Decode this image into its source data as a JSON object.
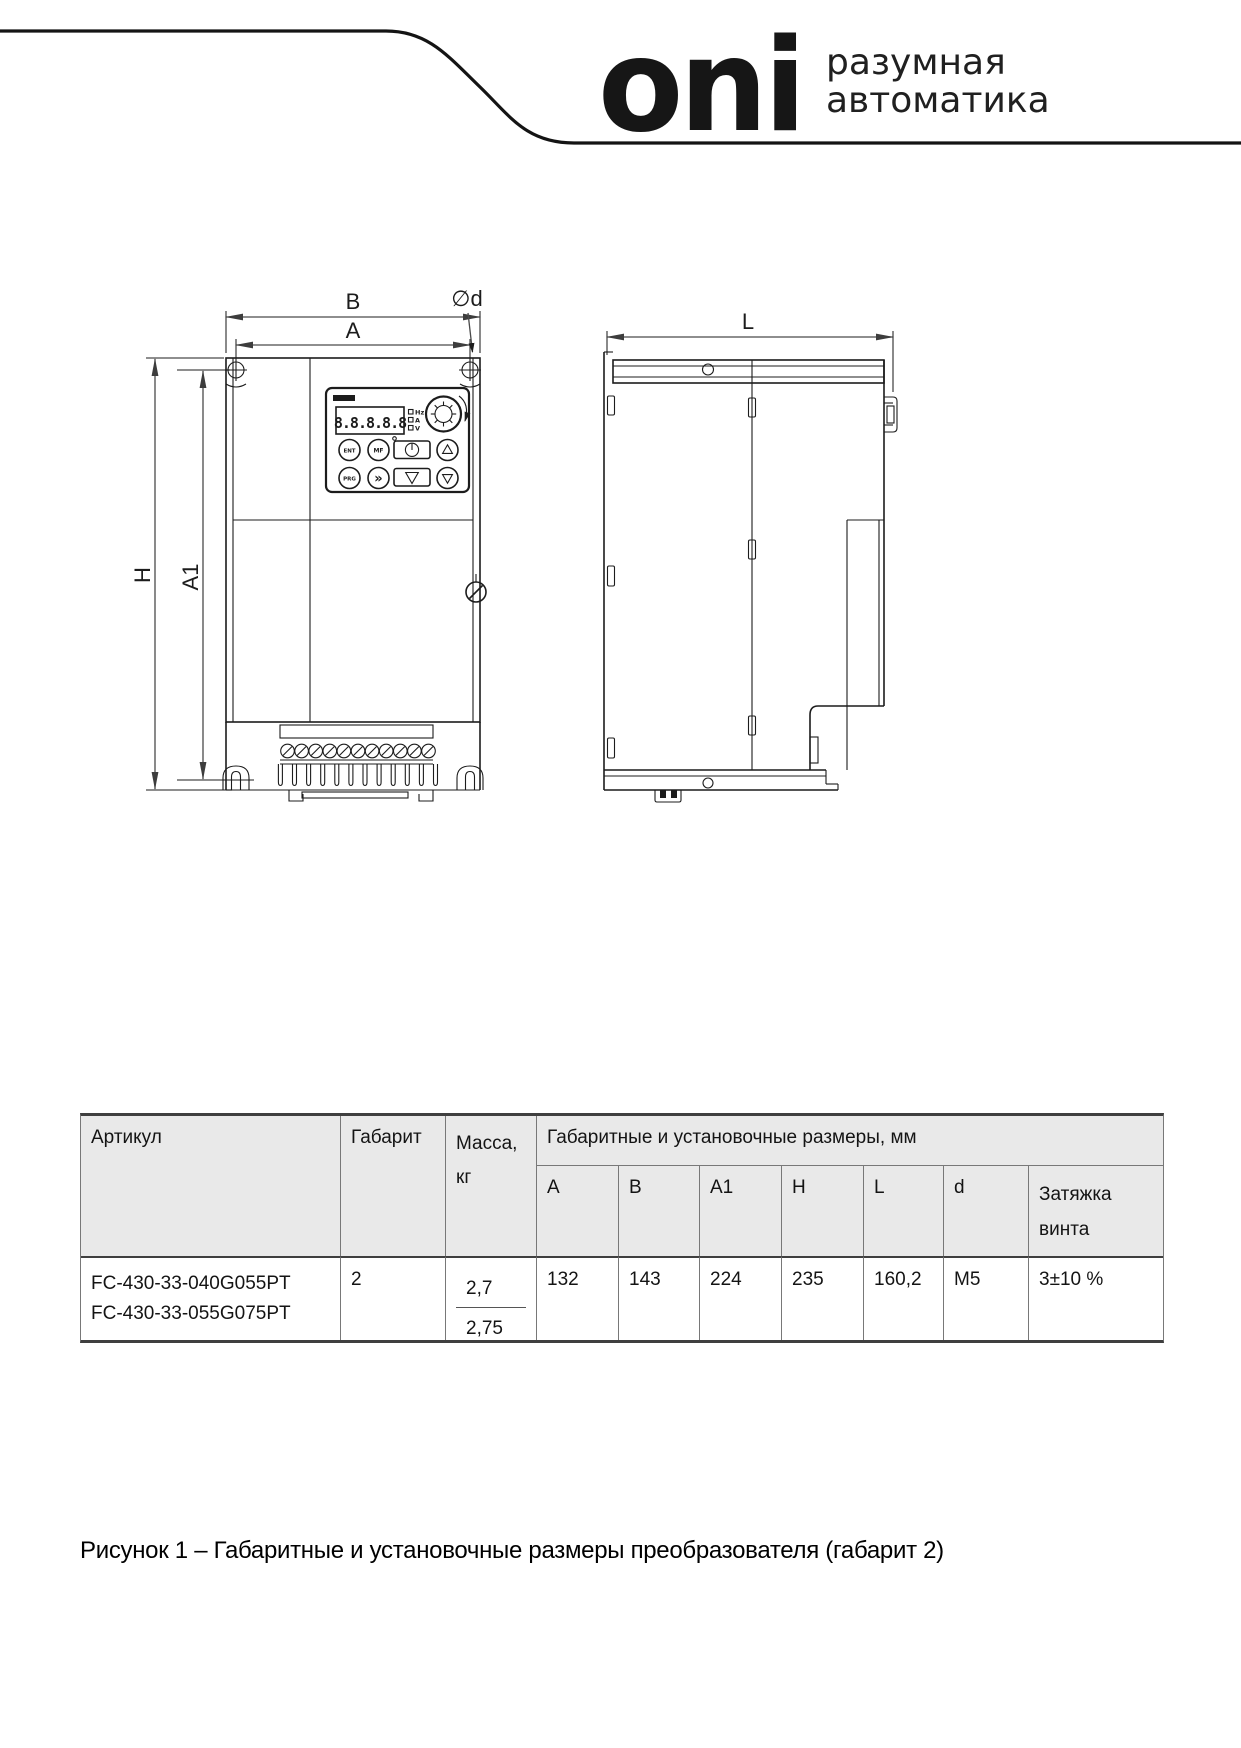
{
  "brand": {
    "logo_text": "oni",
    "tagline": "разумная\nавтоматика"
  },
  "drawing": {
    "front_view": {
      "dim_b": "B",
      "dim_a": "A",
      "dim_h": "H",
      "dim_a1": "A1",
      "dim_d": "∅d",
      "panel": {
        "display_value": "8.8.8.8.8",
        "indicators": [
          "Hz",
          "A",
          "V"
        ],
        "btn_ent": "ENT",
        "btn_mf": "MF",
        "btn_prg": "PRG",
        "btn_fwd": "»"
      }
    },
    "side_view": {
      "dim_l": "L"
    }
  },
  "table": {
    "header": {
      "article": "Артикул",
      "size_class": "Габарит",
      "mass": "Масса,\nкг",
      "dims_group": "Габаритные и установочные размеры, мм",
      "sub": [
        "A",
        "B",
        "A1",
        "H",
        "L",
        "d",
        "Затяжка\nвинта\n(Н*м)"
      ]
    },
    "row": {
      "article_line1": "FC-430-33-040G055PT",
      "article_line2": "FC-430-33-055G075PT",
      "size_class": "2",
      "mass_1": "2,7",
      "mass_2": "2,75",
      "a": "132",
      "b": "143",
      "a1": "224",
      "h": "235",
      "l": "160,2",
      "d": "M5",
      "torque": "3±10 %"
    }
  },
  "caption": "Рисунок 1 – Габаритные и установочные размеры преобразователя (габарит 2)"
}
